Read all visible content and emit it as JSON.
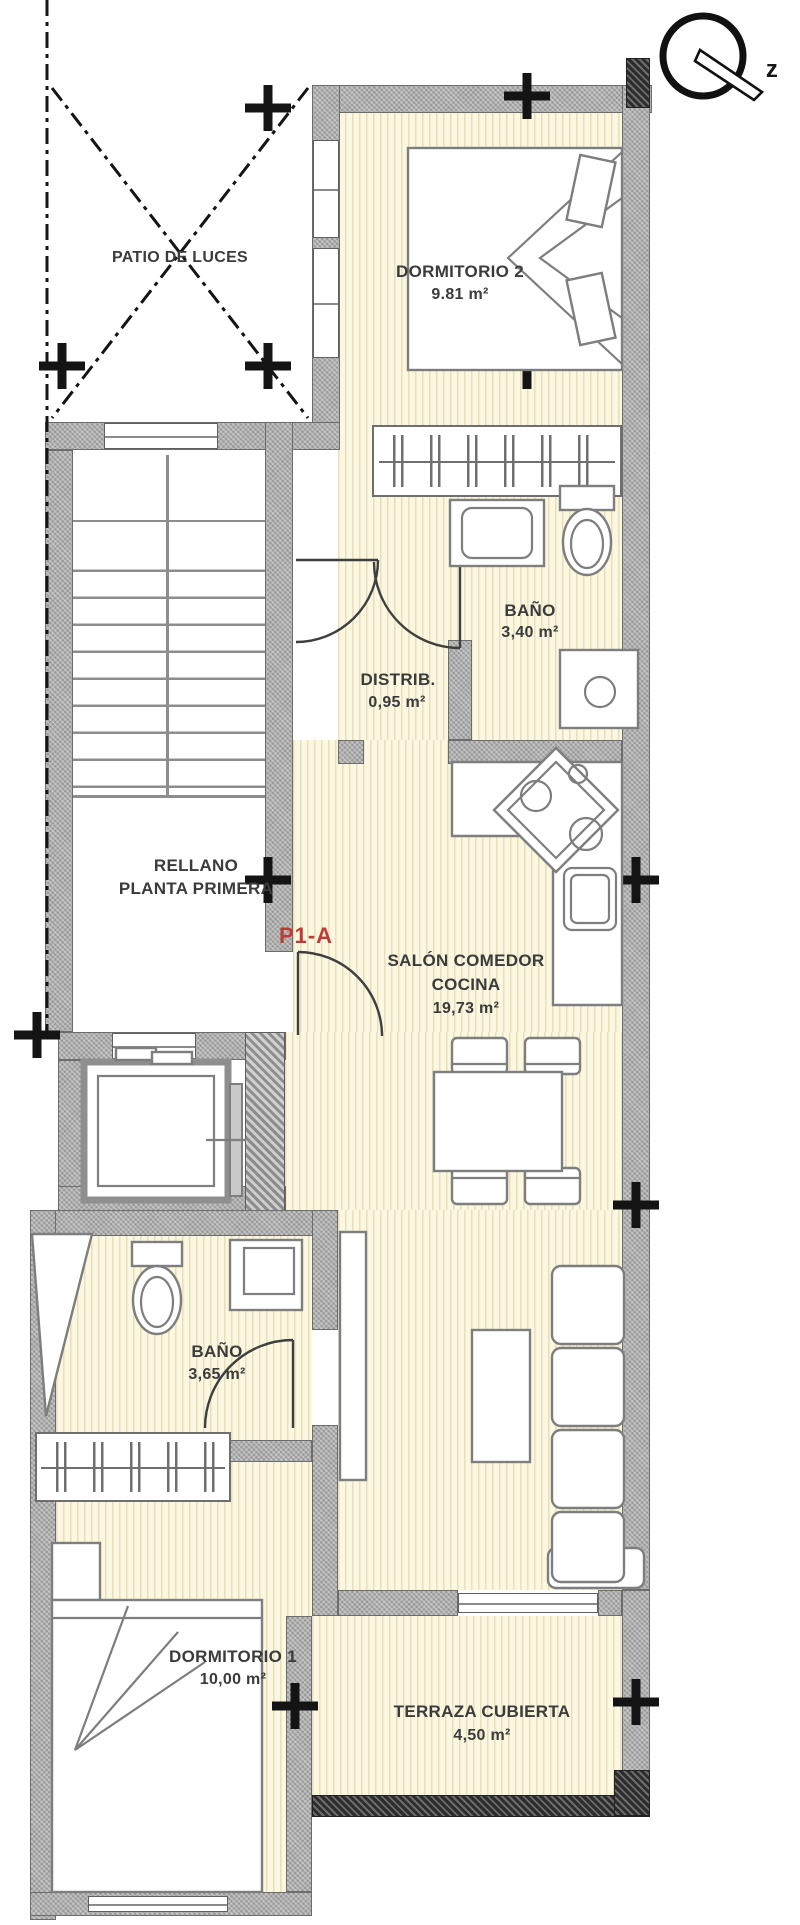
{
  "compass": {
    "letter": "z"
  },
  "unit": {
    "label": "P1-A",
    "color": "#c13b36"
  },
  "rooms": {
    "patio": {
      "name": "PATIO DE LUCES"
    },
    "dormitorio2": {
      "name": "DORMITORIO 2",
      "area": "9.81 m²"
    },
    "bano1": {
      "name": "BAÑO",
      "area": "3,40 m²"
    },
    "distribuidor": {
      "name": "DISTRIB.",
      "area": "0,95 m²"
    },
    "rellano": {
      "name_line1": "RELLANO",
      "name_line2": "PLANTA PRIMERA"
    },
    "salon": {
      "name_line1": "SALÓN COMEDOR",
      "name_line2": "COCINA",
      "area": "19,73 m²"
    },
    "bano2": {
      "name": "BAÑO",
      "area": "3,65 m²"
    },
    "dormitorio1": {
      "name": "DORMITORIO 1",
      "area": "10,00 m²"
    },
    "terraza": {
      "name": "TERRAZA CUBIERTA",
      "area": "4,50 m²"
    }
  },
  "colors": {
    "floor": "#fbf7e0",
    "floor_stripe": "#e7dfbd",
    "wall": "#adadad",
    "wall_outline": "#6c6c6c",
    "accent_red": "#c13b36"
  }
}
